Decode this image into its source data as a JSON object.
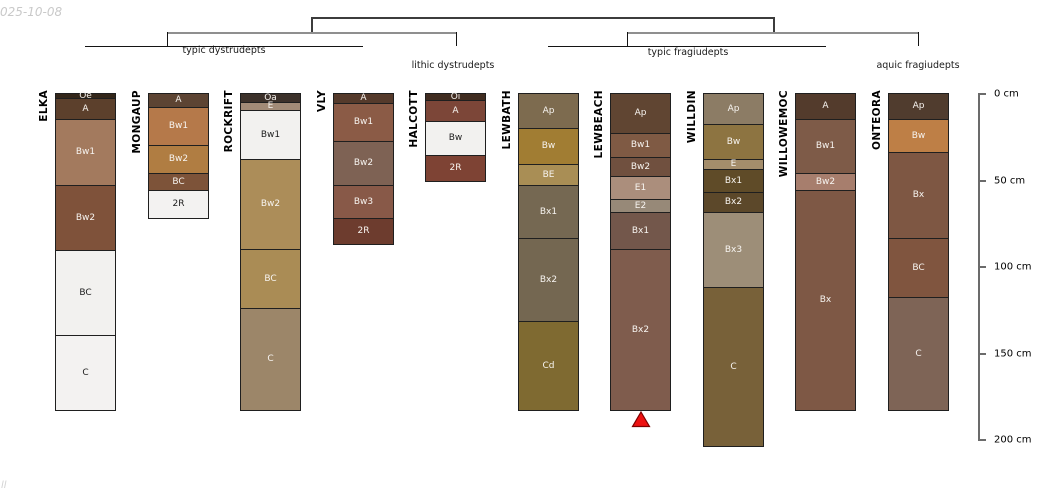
{
  "meta": {
    "date_watermark": "025-10-08",
    "corner_mark": "ll",
    "background": "#ffffff"
  },
  "depth_axis": {
    "unit": "cm",
    "ticks_cm": [
      0,
      50,
      100,
      150,
      200
    ],
    "tick_labels": [
      "0 cm",
      "50 cm",
      "100 cm",
      "150 cm",
      "200 cm"
    ],
    "range_cm": [
      0,
      200
    ],
    "line_color": "#6b6b6b"
  },
  "dendrogram": {
    "labels": [
      {
        "text": "typic dystrudepts",
        "x": 224,
        "y": 45
      },
      {
        "text": "lithic dystrudepts",
        "x": 453,
        "y": 60
      },
      {
        "text": "typic fragiudepts",
        "x": 688,
        "y": 47
      },
      {
        "text": "aquic fragiudepts",
        "x": 918,
        "y": 60
      }
    ],
    "segments": [
      {
        "x1": 311,
        "y1": 17,
        "x2": 773,
        "y2": 17,
        "t": 1.5,
        "c": "#3c3c3c"
      },
      {
        "x1": 311,
        "y1": 17,
        "x2": 311,
        "y2": 33,
        "t": 1.5,
        "c": "#3c3c3c"
      },
      {
        "x1": 773,
        "y1": 17,
        "x2": 773,
        "y2": 33,
        "t": 1.5,
        "c": "#3c3c3c"
      },
      {
        "x1": 167,
        "y1": 32,
        "x2": 456,
        "y2": 32,
        "t": 2,
        "c": "#8f8f8f"
      },
      {
        "x1": 627,
        "y1": 32,
        "x2": 918,
        "y2": 32,
        "t": 2,
        "c": "#8f8f8f"
      },
      {
        "x1": 167,
        "y1": 32,
        "x2": 167,
        "y2": 46,
        "t": 1.2,
        "c": "#141414"
      },
      {
        "x1": 456,
        "y1": 32,
        "x2": 456,
        "y2": 46,
        "t": 1.2,
        "c": "#141414"
      },
      {
        "x1": 627,
        "y1": 32,
        "x2": 627,
        "y2": 46,
        "t": 1.2,
        "c": "#141414"
      },
      {
        "x1": 918,
        "y1": 32,
        "x2": 918,
        "y2": 46,
        "t": 1.2,
        "c": "#141414"
      },
      {
        "x1": 85,
        "y1": 46,
        "x2": 363,
        "y2": 46,
        "t": 1.2,
        "c": "#141414"
      },
      {
        "x1": 548,
        "y1": 46,
        "x2": 826,
        "y2": 46,
        "t": 1.2,
        "c": "#141414"
      }
    ]
  },
  "chart_data": {
    "type": "soil-horizon-columns",
    "ylabel": "depth (cm)",
    "ylim": [
      0,
      200
    ],
    "classification_groups": [
      {
        "label": "typic dystrudepts",
        "members": [
          "ELKA",
          "MONGAUP",
          "ROCKRIFT",
          "VLY"
        ]
      },
      {
        "label": "lithic dystrudepts",
        "members": [
          "HALCOTT"
        ]
      },
      {
        "label": "typic fragiudepts",
        "members": [
          "LEWBATH",
          "LEWBEACH",
          "WILLDIN",
          "WILLOWEMOC"
        ]
      },
      {
        "label": "aquic fragiudepts",
        "members": [
          "ONTEORA"
        ]
      }
    ],
    "marker": {
      "below_profile": "LEWBEACH",
      "shape": "triangle-up",
      "fill": "#ee1111",
      "stroke": "#7e0000"
    },
    "profiles": [
      {
        "name": "ELKA",
        "horizons": [
          {
            "label": "Oe",
            "top_cm": 0,
            "bottom_cm": 3,
            "color": "#332619"
          },
          {
            "label": "A",
            "top_cm": 3,
            "bottom_cm": 15,
            "color": "#5c402c"
          },
          {
            "label": "Bw1",
            "top_cm": 15,
            "bottom_cm": 53,
            "color": "#a37a5e"
          },
          {
            "label": "Bw2",
            "top_cm": 53,
            "bottom_cm": 91,
            "color": "#7f523a"
          },
          {
            "label": "BC",
            "top_cm": 91,
            "bottom_cm": 140,
            "color": "#f2f1ef",
            "text": "#1c1c1c"
          },
          {
            "label": "C",
            "top_cm": 140,
            "bottom_cm": 183,
            "color": "#f3f2f1",
            "text": "#1c1c1c"
          }
        ]
      },
      {
        "name": "MONGAUP",
        "horizons": [
          {
            "label": "A",
            "top_cm": 0,
            "bottom_cm": 8,
            "color": "#5d4433"
          },
          {
            "label": "Bw1",
            "top_cm": 8,
            "bottom_cm": 30,
            "color": "#b5794a"
          },
          {
            "label": "Bw2",
            "top_cm": 30,
            "bottom_cm": 46,
            "color": "#b07d42"
          },
          {
            "label": "BC",
            "top_cm": 46,
            "bottom_cm": 56,
            "color": "#7d5339"
          },
          {
            "label": "2R",
            "top_cm": 56,
            "bottom_cm": 72,
            "color": "#f3f2f1",
            "text": "#1c1c1c"
          }
        ]
      },
      {
        "name": "ROCKRIFT",
        "horizons": [
          {
            "label": "Oa",
            "top_cm": 0,
            "bottom_cm": 5,
            "color": "#3c312a"
          },
          {
            "label": "E",
            "top_cm": 5,
            "bottom_cm": 10,
            "color": "#a28b77"
          },
          {
            "label": "Bw1",
            "top_cm": 10,
            "bottom_cm": 38,
            "color": "#f2f1ef",
            "text": "#1c1c1c"
          },
          {
            "label": "Bw2",
            "top_cm": 38,
            "bottom_cm": 90,
            "color": "#ac8d59"
          },
          {
            "label": "BC",
            "top_cm": 90,
            "bottom_cm": 124,
            "color": "#aa8c55"
          },
          {
            "label": "C",
            "top_cm": 124,
            "bottom_cm": 183,
            "color": "#9c8669"
          }
        ]
      },
      {
        "name": "VLY",
        "horizons": [
          {
            "label": "A",
            "top_cm": 0,
            "bottom_cm": 6,
            "color": "#553a2b"
          },
          {
            "label": "Bw1",
            "top_cm": 6,
            "bottom_cm": 28,
            "color": "#8b5b46"
          },
          {
            "label": "Bw2",
            "top_cm": 28,
            "bottom_cm": 53,
            "color": "#7e6254"
          },
          {
            "label": "Bw3",
            "top_cm": 53,
            "bottom_cm": 72,
            "color": "#885948"
          },
          {
            "label": "2R",
            "top_cm": 72,
            "bottom_cm": 87,
            "color": "#6d3c2e"
          }
        ]
      },
      {
        "name": "HALCOTT",
        "horizons": [
          {
            "label": "Oi",
            "top_cm": 0,
            "bottom_cm": 4,
            "color": "#402c20"
          },
          {
            "label": "A",
            "top_cm": 4,
            "bottom_cm": 16,
            "color": "#7c4638"
          },
          {
            "label": "Bw",
            "top_cm": 16,
            "bottom_cm": 36,
            "color": "#f2f1ef",
            "text": "#1c1c1c"
          },
          {
            "label": "2R",
            "top_cm": 36,
            "bottom_cm": 51,
            "color": "#7e4334"
          }
        ]
      },
      {
        "name": "LEWBATH",
        "horizons": [
          {
            "label": "Ap",
            "top_cm": 0,
            "bottom_cm": 20,
            "color": "#7d6b4f"
          },
          {
            "label": "Bw",
            "top_cm": 20,
            "bottom_cm": 41,
            "color": "#a17d33"
          },
          {
            "label": "BE",
            "top_cm": 41,
            "bottom_cm": 53,
            "color": "#a98e55"
          },
          {
            "label": "Bx1",
            "top_cm": 53,
            "bottom_cm": 84,
            "color": "#756852"
          },
          {
            "label": "Bx2",
            "top_cm": 84,
            "bottom_cm": 132,
            "color": "#746751"
          },
          {
            "label": "Cd",
            "top_cm": 132,
            "bottom_cm": 183,
            "color": "#7f6a31"
          }
        ]
      },
      {
        "name": "LEWBEACH",
        "marker": true,
        "horizons": [
          {
            "label": "Ap",
            "top_cm": 0,
            "bottom_cm": 23,
            "color": "#604532"
          },
          {
            "label": "Bw1",
            "top_cm": 23,
            "bottom_cm": 37,
            "color": "#7f5a44"
          },
          {
            "label": "Bw2",
            "top_cm": 37,
            "bottom_cm": 48,
            "color": "#70503f"
          },
          {
            "label": "E1",
            "top_cm": 48,
            "bottom_cm": 61,
            "color": "#ab8e7c"
          },
          {
            "label": "E2",
            "top_cm": 61,
            "bottom_cm": 69,
            "color": "#978978"
          },
          {
            "label": "Bx1",
            "top_cm": 69,
            "bottom_cm": 90,
            "color": "#73574b"
          },
          {
            "label": "Bx2",
            "top_cm": 90,
            "bottom_cm": 183,
            "color": "#7f5c4d"
          }
        ]
      },
      {
        "name": "WILLDIN",
        "horizons": [
          {
            "label": "Ap",
            "top_cm": 0,
            "bottom_cm": 18,
            "color": "#8c7c65"
          },
          {
            "label": "Bw",
            "top_cm": 18,
            "bottom_cm": 38,
            "color": "#8d7441"
          },
          {
            "label": "E",
            "top_cm": 38,
            "bottom_cm": 44,
            "color": "#a48d6b"
          },
          {
            "label": "Bx1",
            "top_cm": 44,
            "bottom_cm": 57,
            "color": "#5f4b28"
          },
          {
            "label": "Bx2",
            "top_cm": 57,
            "bottom_cm": 69,
            "color": "#5c482a"
          },
          {
            "label": "Bx3",
            "top_cm": 69,
            "bottom_cm": 112,
            "color": "#9d8e78"
          },
          {
            "label": "C",
            "top_cm": 112,
            "bottom_cm": 204,
            "color": "#786139"
          }
        ]
      },
      {
        "name": "WILLOWEMOC",
        "horizons": [
          {
            "label": "A",
            "top_cm": 0,
            "bottom_cm": 15,
            "color": "#533b2c"
          },
          {
            "label": "Bw1",
            "top_cm": 15,
            "bottom_cm": 46,
            "color": "#7e5b48"
          },
          {
            "label": "Bw2",
            "top_cm": 46,
            "bottom_cm": 56,
            "color": "#a77e6d"
          },
          {
            "label": "Bx",
            "top_cm": 56,
            "bottom_cm": 183,
            "color": "#7e5845"
          }
        ]
      },
      {
        "name": "ONTEORA",
        "horizons": [
          {
            "label": "Ap",
            "top_cm": 0,
            "bottom_cm": 15,
            "color": "#503c2e"
          },
          {
            "label": "Bw",
            "top_cm": 15,
            "bottom_cm": 34,
            "color": "#be7f46"
          },
          {
            "label": "Bx",
            "top_cm": 34,
            "bottom_cm": 84,
            "color": "#7e5743"
          },
          {
            "label": "BC",
            "top_cm": 84,
            "bottom_cm": 118,
            "color": "#80553f"
          },
          {
            "label": "C",
            "top_cm": 118,
            "bottom_cm": 183,
            "color": "#7e6456"
          }
        ]
      }
    ]
  }
}
